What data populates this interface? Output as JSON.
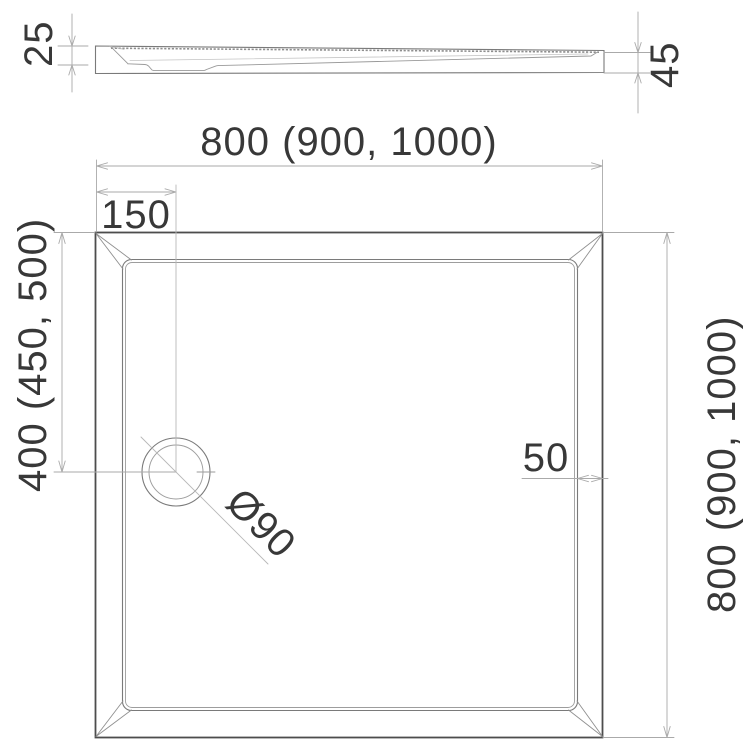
{
  "meta": {
    "description": "Technical dimension drawing of a square shower tray: side profile (top) and plan view (bottom)"
  },
  "colors": {
    "background": "#ffffff",
    "outline_dark": "#4d4d4d",
    "outline_medium": "#7a7a7a",
    "outline_light": "#9d9d9d",
    "dim_line": "#aaaaaa",
    "text": "#383838"
  },
  "side_view": {
    "dim_left_thickness": "25",
    "dim_right_height": "45"
  },
  "plan_view": {
    "dim_width_top": "800 (900, 1000)",
    "dim_height_right": "800 (900, 1000)",
    "dim_drain_from_left": "150",
    "dim_drain_from_top": "400 (450, 500)",
    "dim_rim_width": "50",
    "dim_drain_diameter": "Ø90"
  }
}
